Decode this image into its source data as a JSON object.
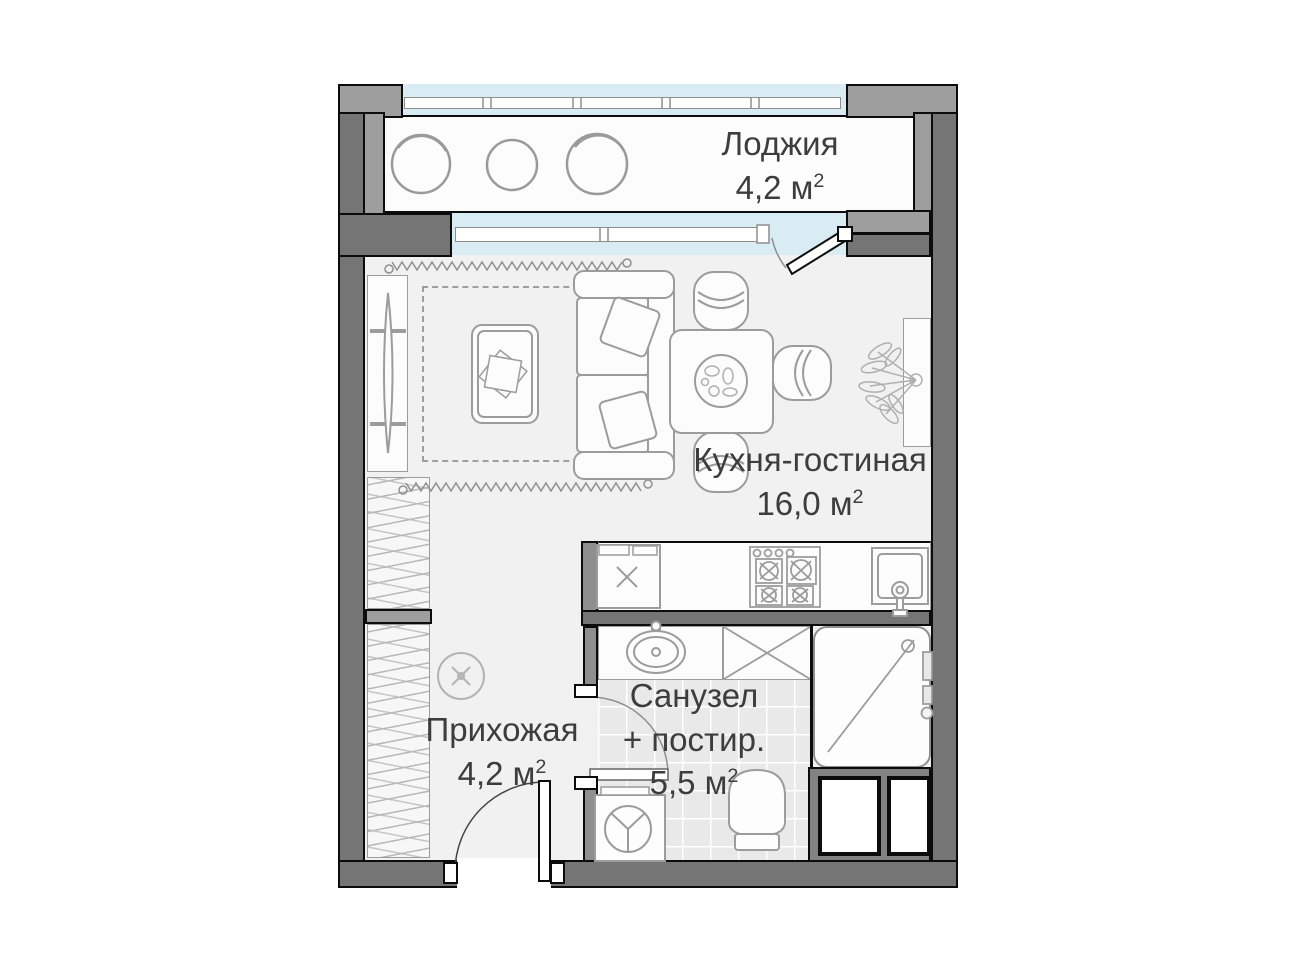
{
  "floorplan": {
    "rooms": [
      {
        "id": "loggia",
        "name": "Лоджия",
        "area": "4,2 м",
        "area_sup": "2"
      },
      {
        "id": "kitchen_living",
        "name": "Кухня-гостиная",
        "area": "16,0 м",
        "area_sup": "2"
      },
      {
        "id": "bathroom",
        "name": "Санузел",
        "name_line2": "+ постир.",
        "area": "5,5 м",
        "area_sup": "2"
      },
      {
        "id": "hallway",
        "name": "Прихожая",
        "area": "4,2 м",
        "area_sup": "2"
      }
    ],
    "colors": {
      "background": "#ffffff",
      "wall_dark": "#757575",
      "wall_mid": "#8f8f8f",
      "wall_light": "#9e9e9e",
      "outline": "#0c0c0c",
      "glazing": "#d9ecf4",
      "floor": "#f1f1f1",
      "tile": "#e9e9e9",
      "furniture_line": "#9c9c9c",
      "text": "#3d3d3d"
    },
    "icons": {
      "loggia-pouf-icon": "hand-drawn circle",
      "curtain-icon": "zigzag line",
      "tv-icon": "thin lens on console",
      "rug-icon": "dashed rectangle",
      "coffee-table-icon": "rounded rectangle with books",
      "sofa-icon": "sofa outline with pillows",
      "dining-table-icon": "square table with plate",
      "chair-icon": "rounded chair with backrest arc",
      "plant-icon": "leaf doodle",
      "fridge-icon": "box with x",
      "stove-icon": "4-burner cooktop",
      "kitchen-sink-icon": "square sink with faucet",
      "bath-sink-icon": "oval basin",
      "linen-cabinet-icon": "box with cross",
      "shower-icon": "rounded cabin with diagonal",
      "toilet-icon": "bowl outline",
      "washing-machine-icon": "box with drum circle",
      "ceiling-light-icon": "circle with cross",
      "door-icon": "leaf with swing arc",
      "duct-shaft-icon": "white box with thick black border"
    }
  }
}
